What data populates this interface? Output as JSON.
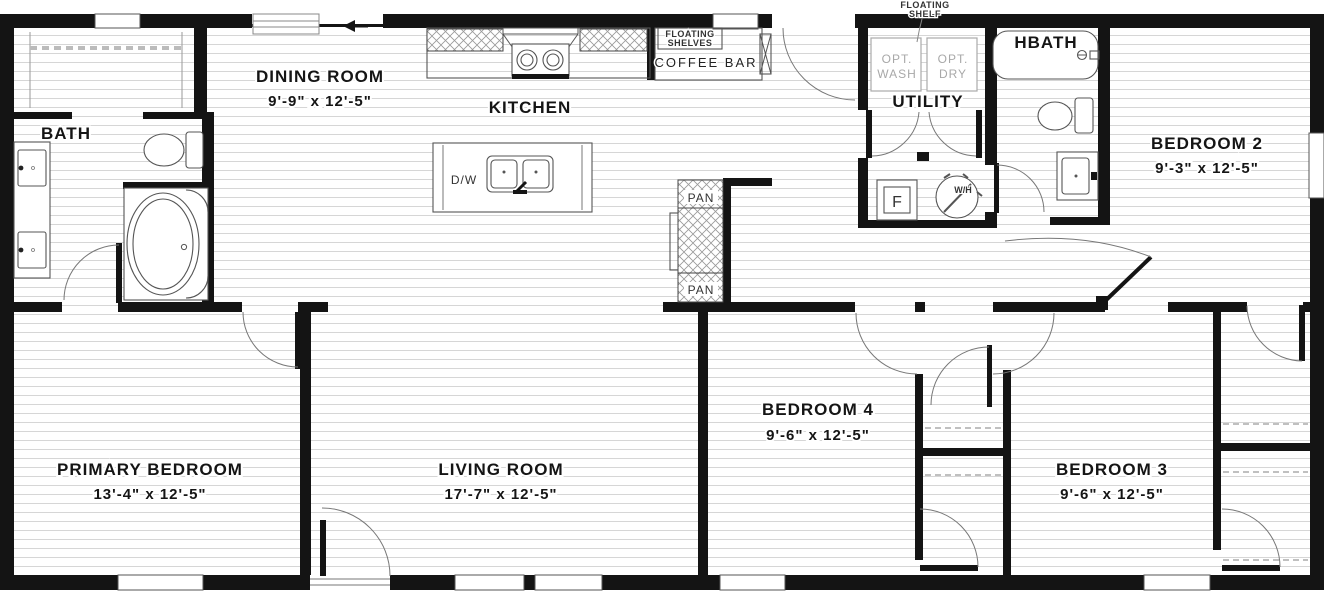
{
  "colors": {
    "wall": "#141414",
    "floor_line": "#d6d6d6",
    "fixture_stroke": "#555555",
    "light_text": "#a8a8a8",
    "label_text": "#151515"
  },
  "plan": {
    "rooms": {
      "dining": {
        "name": "DINING ROOM",
        "dims": "9'-9\" x  12'-5\""
      },
      "kitchen": {
        "name": "KITCHEN"
      },
      "bath": {
        "name": "BATH"
      },
      "primary": {
        "name": "PRIMARY BEDROOM",
        "dims": "13'-4\" x  12'-5\""
      },
      "living": {
        "name": "LIVING ROOM",
        "dims": "17'-7\" x  12'-5\""
      },
      "bedroom4": {
        "name": "BEDROOM 4",
        "dims": "9'-6\" x  12'-5\""
      },
      "bedroom3": {
        "name": "BEDROOM 3",
        "dims": "9'-6\" x  12'-5\""
      },
      "bedroom2": {
        "name": "BEDROOM 2",
        "dims": "9'-3\" x  12'-5\""
      },
      "hbath": {
        "name": "HBATH"
      },
      "utility": {
        "name": "UTILITY"
      }
    },
    "features": {
      "floating_shelves_line1": "FLOATING",
      "floating_shelves_line2": "SHELVES",
      "coffee_bar": "COFFEE BAR",
      "floating_shelf_line1": "FLOATING",
      "floating_shelf_line2": "SHELF",
      "pantry_top": "PAN",
      "pantry_bottom": "PAN",
      "dishwasher": "D/W",
      "furnace": "F",
      "water_heater": "W/H",
      "opt_wash_line1": "OPT.",
      "opt_wash_line2": "WASH",
      "opt_dry_line1": "OPT.",
      "opt_dry_line2": "DRY"
    }
  }
}
